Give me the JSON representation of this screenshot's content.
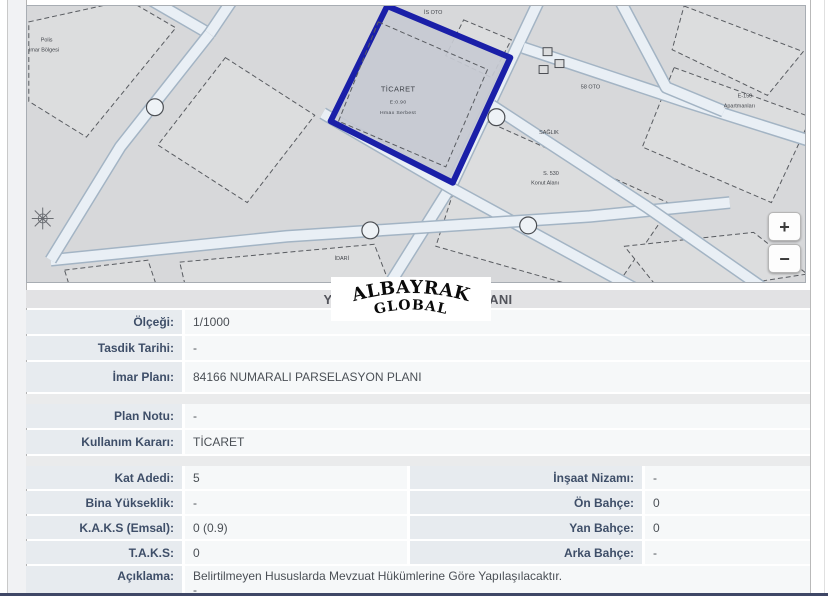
{
  "header": {
    "title": "YÜRÜRLÜKTEKİ İMAR PLANI"
  },
  "watermark": {
    "top": "ALBAYRAK",
    "bottom": "GLOBAL"
  },
  "map": {
    "background": "#d7d8da",
    "block_fill": "#dcddde",
    "dash_color": "#585b60",
    "road_fill": "#e9eff5",
    "road_casing": "#a3b4c4",
    "parcel_outline_color": "#1a1fa8",
    "parcel_fill": "#c7cad3",
    "parcel_points": "361,0 485,52 427,178 304,116",
    "inner_dash": "352,16 462,64 420,162 312,116",
    "parcel_label": {
      "line1": "TİCARET",
      "line2": "E:0.90",
      "line3": "Hmax Serbest",
      "x": 372,
      "y1": 86,
      "y2": 98,
      "y3": 109
    },
    "roads": [
      [
        [
          517,
          -12
        ],
        [
          426,
          180
        ],
        [
          356,
          292
        ]
      ],
      [
        [
          296,
          108
        ],
        [
          430,
          186
        ],
        [
          624,
          292
        ]
      ],
      [
        [
          22,
          256
        ],
        [
          260,
          232
        ],
        [
          565,
          212
        ],
        [
          706,
          198
        ]
      ],
      [
        [
          498,
          42
        ],
        [
          660,
          96
        ],
        [
          800,
          140
        ]
      ],
      [
        [
          113,
          -12
        ],
        [
          182,
          28
        ]
      ],
      [
        [
          209,
          -12
        ],
        [
          182,
          28
        ]
      ],
      [
        [
          182,
          28
        ],
        [
          92,
          142
        ],
        [
          22,
          256
        ]
      ],
      [
        [
          466,
          100
        ],
        [
          622,
          202
        ],
        [
          748,
          290
        ]
      ],
      [
        [
          592,
          -12
        ],
        [
          642,
          82
        ],
        [
          700,
          106
        ]
      ]
    ],
    "dashed_parcels": [
      "152,258 348,240 368,292 160,292",
      "198,52 288,110 220,198 130,140",
      "452,112 648,200 585,292 410,242",
      "438,14 486,34 466,72 420,50",
      "650,62 788,112 748,198 618,142",
      "660,0 780,46 744,90 648,44",
      "600,242 730,228 784,270 640,292",
      "36,266 120,256 132,292 44,292",
      "0,16 100,-6 148,22 58,132 0,96"
    ],
    "labels": [
      {
        "text": "İS OTO",
        "x": 398,
        "y": 8
      },
      {
        "text": "58 OTO",
        "x": 556,
        "y": 83
      },
      {
        "text": "SAĞLIK",
        "x": 514,
        "y": 129
      },
      {
        "text": "S. 530",
        "x": 518,
        "y": 170
      },
      {
        "text": "Konut Alanı",
        "x": 506,
        "y": 180
      },
      {
        "text": "E-150",
        "x": 714,
        "y": 92
      },
      {
        "text": "Apartmanları",
        "x": 700,
        "y": 102
      },
      {
        "text": "İDARİ",
        "x": 308,
        "y": 256
      },
      {
        "text": "Polis",
        "x": 12,
        "y": 36
      },
      {
        "text": "İmar Bölgesi",
        "x": 0,
        "y": 46
      }
    ],
    "bubbles": [
      [
        344,
        226
      ],
      [
        503,
        221
      ],
      [
        471,
        112
      ],
      [
        127,
        102
      ]
    ],
    "squares": [
      [
        518,
        42
      ],
      [
        530,
        54
      ],
      [
        514,
        60
      ]
    ],
    "compass": {
      "x": 14,
      "y": 214
    },
    "controls": {
      "zoom_in": "+",
      "zoom_out": "−"
    }
  },
  "table": {
    "group1": [
      {
        "label": "Ölçeği:",
        "value": "1/1000"
      },
      {
        "label": "Tasdik Tarihi:",
        "value": "-"
      },
      {
        "label": "İmar Planı:",
        "value": "84166 NUMARALI PARSELASYON PLANI"
      }
    ],
    "group2": [
      {
        "label": "Plan Notu:",
        "value": "-"
      },
      {
        "label": "Kullanım Kararı:",
        "value": "TİCARET"
      }
    ],
    "group3_left": [
      {
        "label": "Kat Adedi:",
        "value": "5"
      },
      {
        "label": "Bina Yükseklik:",
        "value": "-"
      },
      {
        "label": "K.A.K.S (Emsal):",
        "value": "0 (0.9)"
      },
      {
        "label": "T.A.K.S:",
        "value": "0"
      }
    ],
    "group3_right": [
      {
        "label": "İnşaat Nizamı:",
        "value": "-"
      },
      {
        "label": "Ön Bahçe:",
        "value": "0"
      },
      {
        "label": "Yan Bahçe:",
        "value": "0"
      },
      {
        "label": "Arka Bahçe:",
        "value": "-"
      }
    ],
    "aciklama": {
      "label": "Açıklama:",
      "value": "Belirtilmeyen Hususlarda Mevzuat Hükümlerine Göre Yapılaşılacaktır.",
      "value2": "-"
    }
  }
}
